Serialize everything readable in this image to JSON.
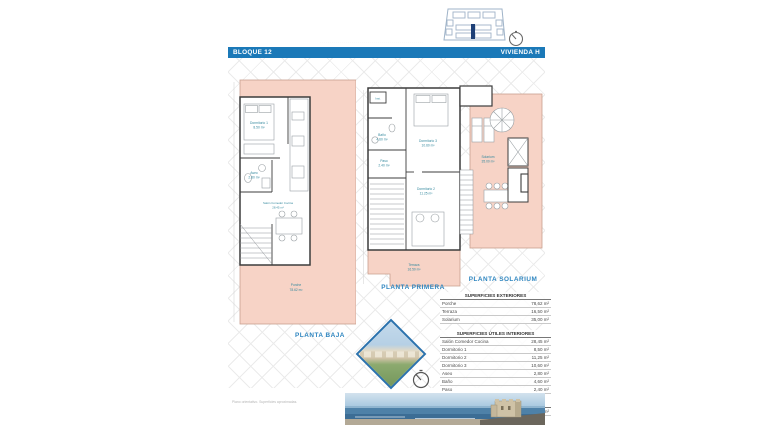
{
  "header": {
    "block_label": "BLOQUE 12",
    "unit_label": "VIVIENDA H"
  },
  "faint_text": "····················································",
  "plans": {
    "baja": {
      "caption": "PLANTA BAJA",
      "dormitorio1": {
        "name": "Dormitorio 1",
        "area": "8.50 m²"
      },
      "aseo": {
        "name": "Aseo",
        "area": "2.80 m²"
      },
      "salon": {
        "name": "Salón Comedor Cocina",
        "area": "28.45 m²"
      },
      "porche": {
        "name": "Porche",
        "area": "78.62 m²"
      }
    },
    "primera": {
      "caption": "PLANTA PRIMERA",
      "inst": {
        "name": "Inst."
      },
      "bano": {
        "name": "Baño",
        "area": "4.60 m²"
      },
      "dormitorio3": {
        "name": "Dormitorio 3",
        "area": "10.60 m²"
      },
      "paso": {
        "name": "Paso",
        "area": "2.40 m²"
      },
      "dormitorio2": {
        "name": "Dormitorio 2",
        "area": "11.25 m²"
      },
      "terraza": {
        "name": "Terraza",
        "area": "16.50 m²"
      }
    },
    "solarium": {
      "caption": "PLANTA SOLARIUM",
      "solarium": {
        "name": "Solarium",
        "area": "35.00 m²"
      }
    }
  },
  "tables": {
    "exteriores": {
      "title": "SUPERFICIES EXTERIORES",
      "rows": [
        {
          "label": "Porche",
          "value": "78,62 m²"
        },
        {
          "label": "Terraza",
          "value": "16,50 m²"
        },
        {
          "label": "Solarium",
          "value": "35,00 m²"
        }
      ]
    },
    "interiores": {
      "title": "SUPERFICIES ÚTILES INTERIORES",
      "rows": [
        {
          "label": "Salón Comedor Cocina",
          "value": "28,45 m²"
        },
        {
          "label": "Dormitorio 1",
          "value": "8,50 m²"
        },
        {
          "label": "Dormitorio 2",
          "value": "11,25 m²"
        },
        {
          "label": "Dormitorio 3",
          "value": "10,60 m²"
        },
        {
          "label": "Aseo",
          "value": "2,80 m²"
        },
        {
          "label": "Baño",
          "value": "4,60 m²"
        },
        {
          "label": "Paso",
          "value": "2,40 m²"
        }
      ]
    },
    "construida": {
      "title": "SUPERFICIE CONSTRUIDA",
      "rows": [
        {
          "label": "",
          "value": "82,74 m²"
        }
      ]
    }
  },
  "fine_print": "Plano orientativo. Superficies aproximadas.",
  "icons": {
    "compass": "compass-icon",
    "site_key": "site-key-plan"
  },
  "colors": {
    "accent_blue": "#1b79b8",
    "caption_blue": "#2f86c0",
    "plan_pink": "#f7d3c6",
    "label_teal": "#35899e",
    "highlight_navy": "#1d3f77"
  }
}
